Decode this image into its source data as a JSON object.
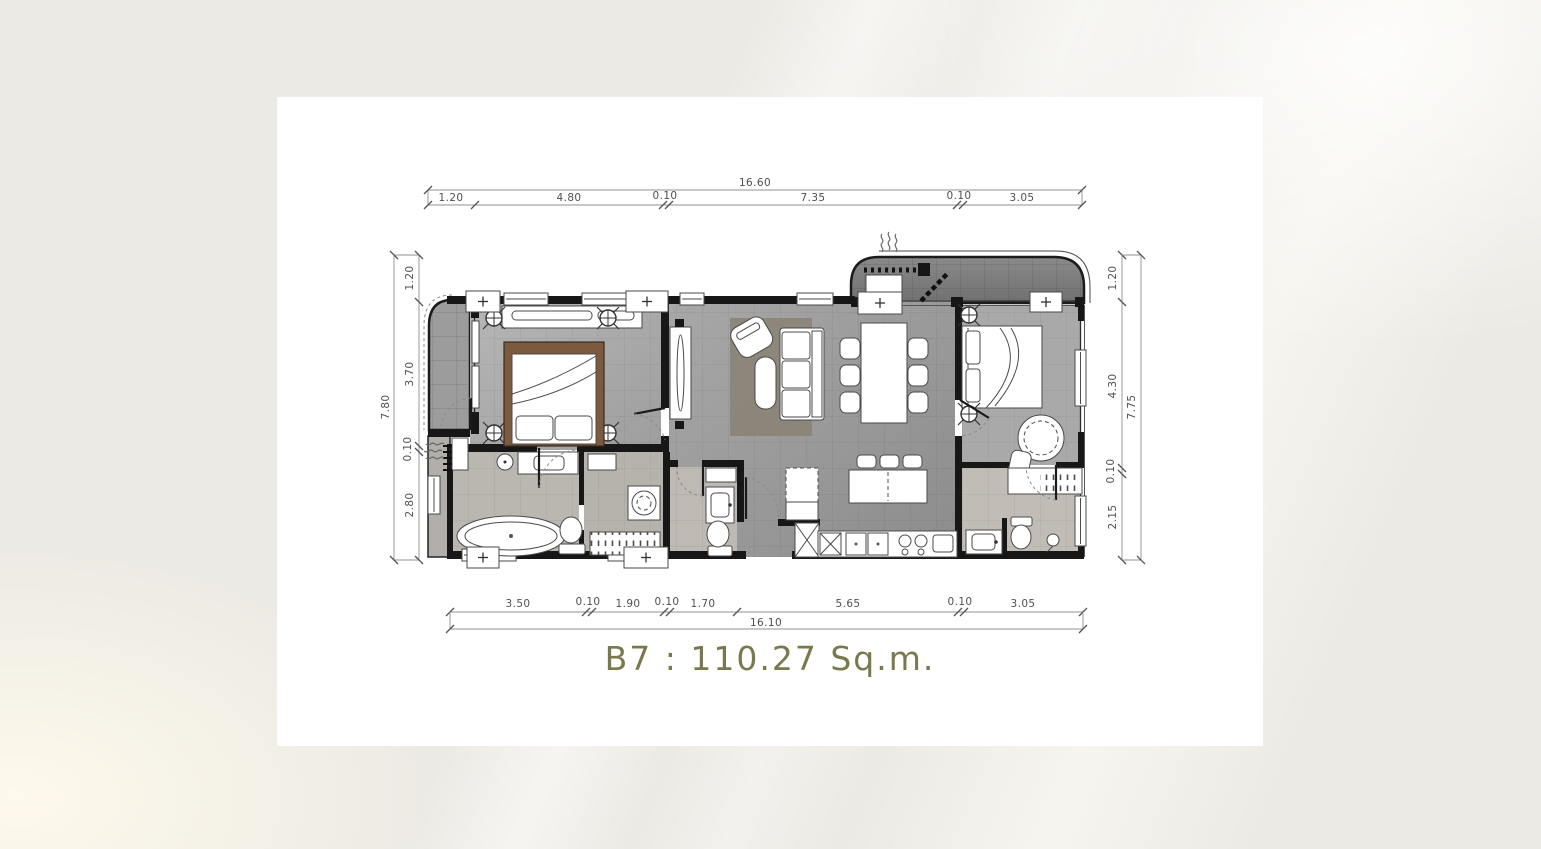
{
  "page": {
    "background_color": "#ECEAE4",
    "card_color": "#FFFFFF"
  },
  "floor_plan": {
    "unit_label": "B7",
    "area_value": "110.27",
    "area_unit": "Sq.m.",
    "title_text": "B7 : 110.27 Sq.m.",
    "title_color": "#7A794E",
    "dimensions": {
      "top": {
        "total": "16.60",
        "segments": [
          "1.20",
          "4.80",
          "0.10",
          "7.35",
          "0.10",
          "3.05"
        ]
      },
      "bottom": {
        "total": "16.10",
        "segments": [
          "3.50",
          "0.10",
          "1.90",
          "0.10",
          "1.70",
          "5.65",
          "0.10",
          "3.05"
        ]
      },
      "left": {
        "total": "7.80",
        "segments": [
          "1.20",
          "3.70",
          "0.10",
          "2.80"
        ]
      },
      "right": {
        "total": "7.75",
        "segments": [
          "1.20",
          "4.30",
          "0.10",
          "2.15"
        ]
      }
    },
    "icons": {
      "steam": "wavy-lines",
      "ceiling_fixture": "circle-crosshair",
      "wall_tag": "plus-box"
    }
  }
}
